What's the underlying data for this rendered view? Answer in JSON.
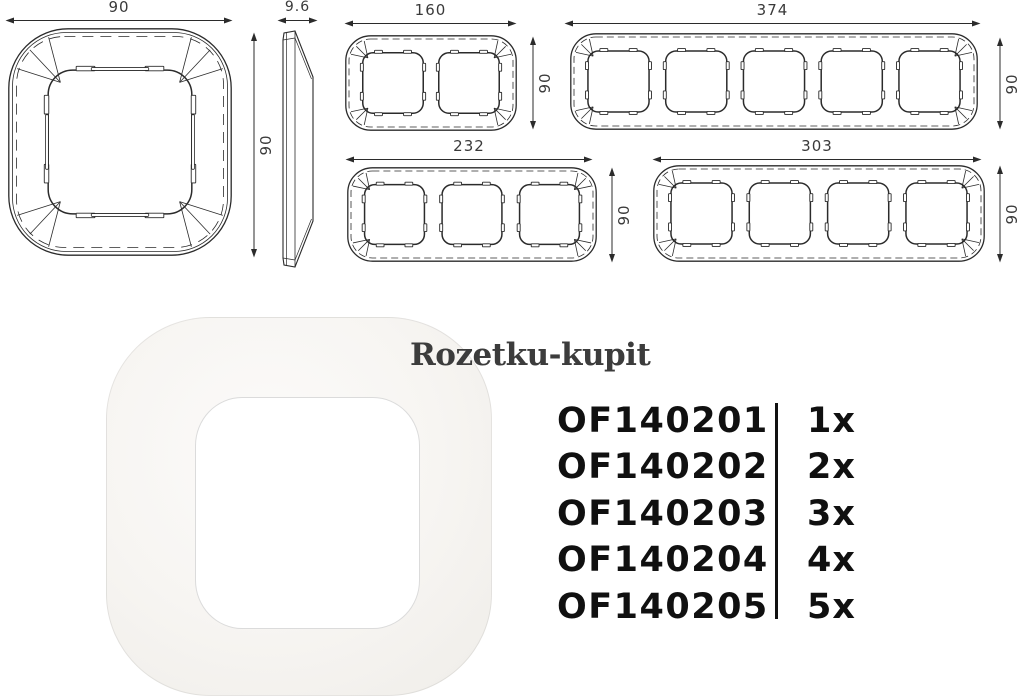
{
  "drawing": {
    "line_color": "#2b2b2b",
    "label_color": "#3a3a3a",
    "views": {
      "single": {
        "gangs": 1,
        "width": "90",
        "height": "90"
      },
      "side": {
        "thickness": "9.6",
        "height": "90"
      },
      "double": {
        "gangs": 2,
        "width": "160",
        "height": "90"
      },
      "quintuple": {
        "gangs": 5,
        "width": "374",
        "height": "90"
      },
      "triple": {
        "gangs": 3,
        "width": "232",
        "height": "90"
      },
      "quadruple": {
        "gangs": 4,
        "width": "303",
        "height": "90"
      }
    }
  },
  "watermark": {
    "text": "Rozetku-kupit",
    "color": "#3c3c3c"
  },
  "product_list": {
    "items": [
      {
        "sku": "OF140201",
        "qty": "1x"
      },
      {
        "sku": "OF140202",
        "qty": "2x"
      },
      {
        "sku": "OF140203",
        "qty": "3x"
      },
      {
        "sku": "OF140204",
        "qty": "4x"
      },
      {
        "sku": "OF140205",
        "qty": "5x"
      }
    ]
  }
}
